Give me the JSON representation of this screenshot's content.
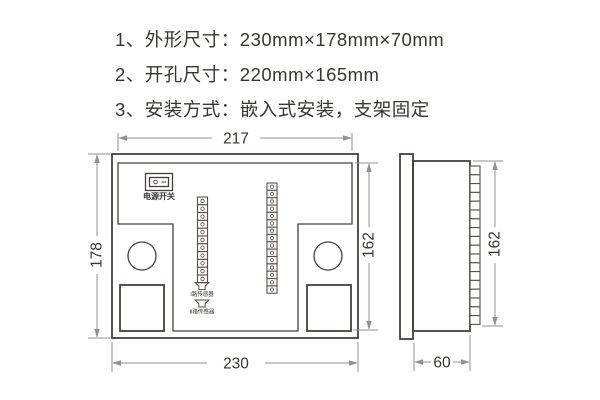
{
  "notes": [
    "1、外形尺寸：230mm×178mm×70mm",
    "2、开孔尺寸：220mm×165mm",
    "3、安装方式：嵌入式安装，支架固定"
  ],
  "back_view": {
    "width_top": "217",
    "height_left": "178",
    "height_right": "162",
    "width_bottom": "230",
    "power_switch_label": "电源开关",
    "sensor1_label": "Ⅰ路传感器",
    "sensor2_label": "Ⅱ路传感器",
    "terminal_strip_left_cells": 11,
    "terminal_strip_right_cells": 15
  },
  "side_view": {
    "height": "162",
    "depth": "60",
    "terminal_cells": 18
  },
  "icons": {
    "power_on_icon": "○",
    "power_off_icon": "—"
  },
  "colors": {
    "outline": "#46403d",
    "dimension_line": "#919191",
    "text": "#3a3532",
    "background": "#ffffff"
  }
}
